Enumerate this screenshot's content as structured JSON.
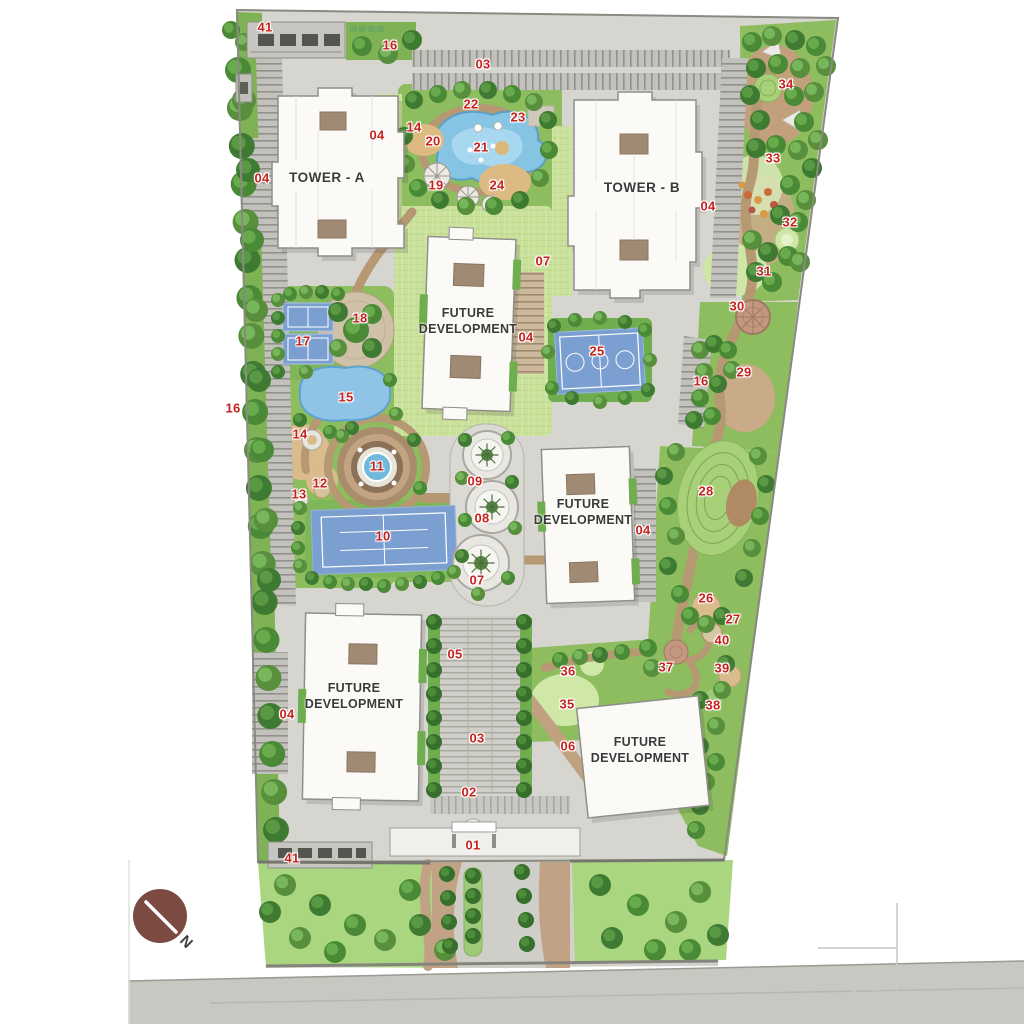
{
  "plan_title": "Residential Master Plan",
  "north_label": "N",
  "buildings": [
    {
      "id": "tower-a",
      "label": "TOWER - A",
      "x": 327,
      "y": 178
    },
    {
      "id": "tower-b",
      "label": "TOWER - B",
      "x": 642,
      "y": 188
    },
    {
      "id": "future-development-center",
      "label": "FUTURE DEVELOPMENT",
      "x": 468,
      "y": 321
    },
    {
      "id": "future-development-east",
      "label": "FUTURE DEVELOPMENT",
      "x": 583,
      "y": 512
    },
    {
      "id": "future-development-southwest",
      "label": "FUTURE DEVELOPMENT",
      "x": 354,
      "y": 696
    },
    {
      "id": "future-development-southeast",
      "label": "FUTURE DEVELOPMENT",
      "x": 640,
      "y": 750
    }
  ],
  "markers": [
    {
      "label": "41",
      "x": 265,
      "y": 27
    },
    {
      "label": "16",
      "x": 390,
      "y": 45
    },
    {
      "label": "03",
      "x": 483,
      "y": 64
    },
    {
      "label": "22",
      "x": 471,
      "y": 104
    },
    {
      "label": "23",
      "x": 518,
      "y": 117
    },
    {
      "label": "14",
      "x": 414,
      "y": 127
    },
    {
      "label": "20",
      "x": 433,
      "y": 141
    },
    {
      "label": "21",
      "x": 481,
      "y": 147
    },
    {
      "label": "04",
      "x": 377,
      "y": 135
    },
    {
      "label": "04",
      "x": 262,
      "y": 178
    },
    {
      "label": "19",
      "x": 436,
      "y": 185
    },
    {
      "label": "24",
      "x": 497,
      "y": 185
    },
    {
      "label": "34",
      "x": 786,
      "y": 84
    },
    {
      "label": "33",
      "x": 773,
      "y": 158
    },
    {
      "label": "04",
      "x": 708,
      "y": 206
    },
    {
      "label": "32",
      "x": 790,
      "y": 222
    },
    {
      "label": "31",
      "x": 764,
      "y": 271
    },
    {
      "label": "30",
      "x": 737,
      "y": 306
    },
    {
      "label": "07",
      "x": 543,
      "y": 261
    },
    {
      "label": "18",
      "x": 360,
      "y": 318
    },
    {
      "label": "17",
      "x": 303,
      "y": 341
    },
    {
      "label": "04",
      "x": 526,
      "y": 337
    },
    {
      "label": "25",
      "x": 597,
      "y": 351
    },
    {
      "label": "16",
      "x": 701,
      "y": 381
    },
    {
      "label": "29",
      "x": 744,
      "y": 372
    },
    {
      "label": "15",
      "x": 346,
      "y": 397
    },
    {
      "label": "16",
      "x": 233,
      "y": 408
    },
    {
      "label": "14",
      "x": 300,
      "y": 434
    },
    {
      "label": "11",
      "x": 377,
      "y": 466
    },
    {
      "label": "28",
      "x": 706,
      "y": 491
    },
    {
      "label": "12",
      "x": 320,
      "y": 483
    },
    {
      "label": "13",
      "x": 299,
      "y": 494
    },
    {
      "label": "09",
      "x": 475,
      "y": 481
    },
    {
      "label": "08",
      "x": 482,
      "y": 518
    },
    {
      "label": "04",
      "x": 643,
      "y": 530
    },
    {
      "label": "10",
      "x": 383,
      "y": 536
    },
    {
      "label": "07",
      "x": 477,
      "y": 580
    },
    {
      "label": "26",
      "x": 706,
      "y": 598
    },
    {
      "label": "27",
      "x": 733,
      "y": 619
    },
    {
      "label": "40",
      "x": 722,
      "y": 640
    },
    {
      "label": "37",
      "x": 666,
      "y": 667
    },
    {
      "label": "39",
      "x": 722,
      "y": 668
    },
    {
      "label": "36",
      "x": 568,
      "y": 671
    },
    {
      "label": "05",
      "x": 455,
      "y": 654
    },
    {
      "label": "35",
      "x": 567,
      "y": 704
    },
    {
      "label": "38",
      "x": 713,
      "y": 705
    },
    {
      "label": "04",
      "x": 287,
      "y": 714
    },
    {
      "label": "03",
      "x": 477,
      "y": 738
    },
    {
      "label": "06",
      "x": 568,
      "y": 746
    },
    {
      "label": "02",
      "x": 469,
      "y": 792
    },
    {
      "label": "41",
      "x": 292,
      "y": 858
    },
    {
      "label": "01",
      "x": 473,
      "y": 845
    }
  ],
  "colors": {
    "marker_red": "#c6231f",
    "court_blue": "#7c9fd1",
    "pool_blue": "#8fc4e6",
    "lawn_green": "#c9e19b",
    "tree_green": "#4a8a36",
    "path_tan": "#b69873",
    "north_circle": "#7d4a42"
  }
}
